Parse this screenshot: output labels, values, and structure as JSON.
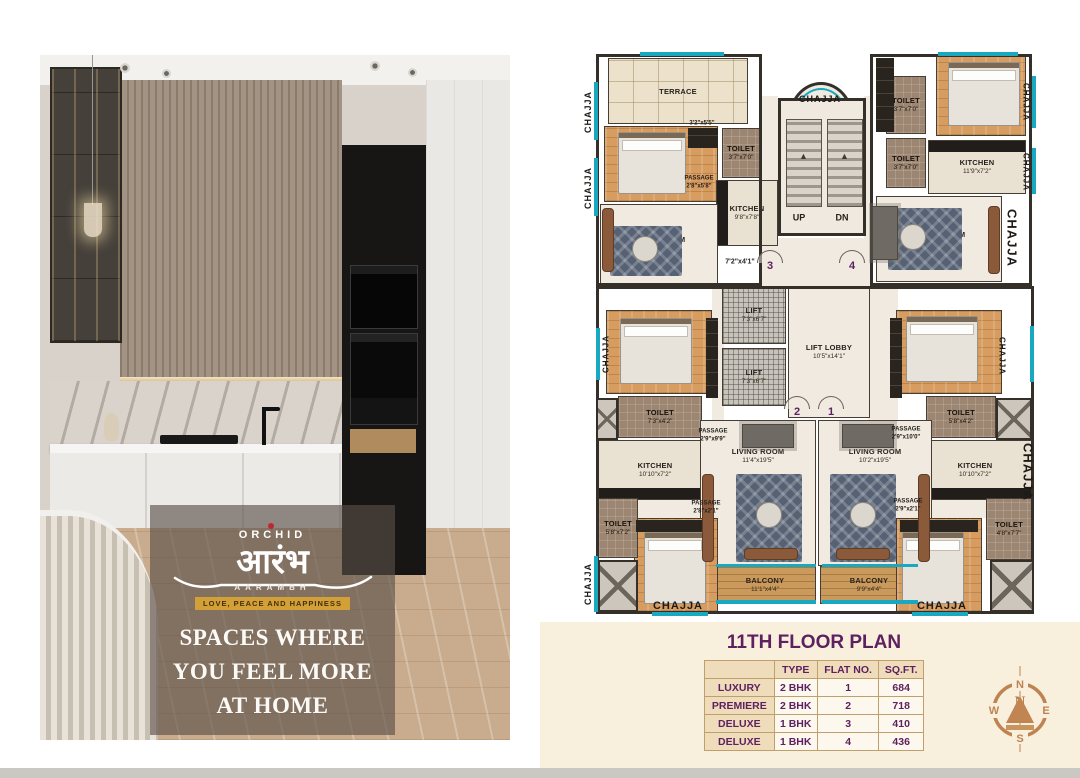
{
  "brand": {
    "name": "ORCHID",
    "devanagari": "आरंभ",
    "latin": "AARAMBH",
    "tagline": "LOVE, PEACE AND HAPPINESS"
  },
  "headline": {
    "lines": [
      "SPACES WHERE",
      "YOU FEEL MORE",
      "AT HOME"
    ]
  },
  "plan": {
    "chajja_text": "CHAJJA",
    "rooms": [
      {
        "name": "TERRACE",
        "dim": "",
        "x": 608,
        "y": 58,
        "w": 140,
        "h": 66,
        "f": "terrace"
      },
      {
        "name": "BEDROOM",
        "dim": "10'10\"x 9'5\"",
        "x": 604,
        "y": 126,
        "w": 114,
        "h": 76,
        "f": "wood"
      },
      {
        "name": "TOILET",
        "dim": "3'7\"x7'0\"",
        "x": 722,
        "y": 128,
        "w": 38,
        "h": 50,
        "f": "toilet"
      },
      {
        "name": "KITCHEN",
        "dim": "9'8\"x7'8\"",
        "x": 716,
        "y": 180,
        "w": 62,
        "h": 66,
        "f": "kitchen",
        "ck": "l"
      },
      {
        "name": "LIVING ROOM",
        "dim": "14'5\"x10'5\"",
        "x": 600,
        "y": 204,
        "w": 118,
        "h": 80,
        "f": "marble"
      },
      {
        "name": "TOILET",
        "dim": "3'7\"x7'0\"",
        "x": 886,
        "y": 76,
        "w": 40,
        "h": 58,
        "f": "toilet"
      },
      {
        "name": "TOILET",
        "dim": "3'7\"x7'0\"",
        "x": 886,
        "y": 138,
        "w": 40,
        "h": 50,
        "f": "toilet"
      },
      {
        "name": "BEDROOM",
        "dim": "11'8\"x9'5\"",
        "x": 936,
        "y": 56,
        "w": 90,
        "h": 80,
        "f": "wood"
      },
      {
        "name": "KITCHEN",
        "dim": "11'9\"x7'2\"",
        "x": 928,
        "y": 140,
        "w": 98,
        "h": 54,
        "f": "kitchen",
        "ck": "t"
      },
      {
        "name": "LIVING ROOM",
        "dim": "16'7\"x9'5\"",
        "x": 876,
        "y": 196,
        "w": 126,
        "h": 86,
        "f": "marble"
      },
      {
        "name": "LIFT",
        "dim": "7'3\"x6'7\"",
        "x": 722,
        "y": 286,
        "w": 64,
        "h": 58,
        "f": "lift"
      },
      {
        "name": "LIFT",
        "dim": "7'3\"x6'7\"",
        "x": 722,
        "y": 348,
        "w": 64,
        "h": 58,
        "f": "lift"
      },
      {
        "name": "LIFT LOBBY",
        "dim": "10'5\"x14'1\"",
        "x": 788,
        "y": 286,
        "w": 82,
        "h": 132,
        "f": "marble"
      },
      {
        "name": "BEDROOM",
        "dim": "11'9\"x10'0\"",
        "x": 606,
        "y": 310,
        "w": 106,
        "h": 84,
        "f": "wood"
      },
      {
        "name": "TOILET",
        "dim": "7'3\"x4'2\"",
        "x": 618,
        "y": 396,
        "w": 84,
        "h": 42,
        "f": "toilet"
      },
      {
        "name": "KITCHEN",
        "dim": "10'10\"x7'2\"",
        "x": 598,
        "y": 440,
        "w": 114,
        "h": 60,
        "f": "kitchen",
        "ck": "b"
      },
      {
        "name": "BEDROOM",
        "dim": "12'3\"x10'0\"",
        "x": 896,
        "y": 310,
        "w": 106,
        "h": 84,
        "f": "wood"
      },
      {
        "name": "TOILET",
        "dim": "5'8\"x4'2\"",
        "x": 926,
        "y": 396,
        "w": 70,
        "h": 42,
        "f": "toilet"
      },
      {
        "name": "KITCHEN",
        "dim": "10'10\"x7'2\"",
        "x": 918,
        "y": 440,
        "w": 114,
        "h": 60,
        "f": "kitchen",
        "ck": "b"
      },
      {
        "name": "LIVING ROOM",
        "dim": "11'4\"x19'5\"",
        "x": 700,
        "y": 420,
        "w": 116,
        "h": 146,
        "f": "marble",
        "la": "t"
      },
      {
        "name": "LIVING ROOM",
        "dim": "10'2\"x19'5\"",
        "x": 818,
        "y": 420,
        "w": 114,
        "h": 146,
        "f": "marble",
        "la": "t"
      },
      {
        "name": "BALCONY",
        "dim": "11'1\"x4'4\"",
        "x": 714,
        "y": 566,
        "w": 102,
        "h": 38,
        "f": "balcony"
      },
      {
        "name": "BALCONY",
        "dim": "9'9\"x4'4\"",
        "x": 820,
        "y": 566,
        "w": 98,
        "h": 38,
        "f": "balcony"
      },
      {
        "name": "BEDROOM",
        "dim": "10'2\"x11'8\"",
        "x": 634,
        "y": 518,
        "w": 84,
        "h": 94,
        "f": "wood"
      },
      {
        "name": "TOILET",
        "dim": "5'8\"x7'2\"",
        "x": 598,
        "y": 498,
        "w": 40,
        "h": 60,
        "f": "toilet"
      },
      {
        "name": "BEDROOM",
        "dim": "10'0\"x11'9\"",
        "x": 896,
        "y": 518,
        "w": 86,
        "h": 94,
        "f": "wood"
      },
      {
        "name": "TOILET",
        "dim": "4'8\"x7'7\"",
        "x": 986,
        "y": 498,
        "w": 46,
        "h": 62,
        "f": "toilet"
      }
    ],
    "labels": [
      {
        "t": "3'2\"x5'5\"",
        "x": 702,
        "y": 124,
        "s": 6
      },
      {
        "t": "PASSAGE",
        "d": "2'8\"x5'8\"",
        "x": 699,
        "y": 183,
        "s": 6
      },
      {
        "t": "7'2\"x4'1\"",
        "x": 740,
        "y": 263,
        "s": 7
      },
      {
        "t": "PASSAGE",
        "d": "2'9\"x9'9\"",
        "x": 713,
        "y": 436,
        "s": 6
      },
      {
        "t": "PASSAGE",
        "d": "2'9\"x10'0\"",
        "x": 906,
        "y": 434,
        "s": 6
      },
      {
        "t": "PASSAGE",
        "d": "2'8\"x2'1\"",
        "x": 706,
        "y": 508,
        "s": 6
      },
      {
        "t": "PASSAGE",
        "d": "2'9\"x2'1\"",
        "x": 908,
        "y": 506,
        "s": 6
      },
      {
        "t": "UP",
        "x": 799,
        "y": 218,
        "s": 9
      },
      {
        "t": "DN",
        "x": 842,
        "y": 218,
        "s": 9
      }
    ],
    "chajja": [
      {
        "x": 588,
        "y": 112,
        "o": "v",
        "s": 9
      },
      {
        "x": 588,
        "y": 188,
        "o": "v",
        "s": 9
      },
      {
        "x": 588,
        "y": 584,
        "o": "v",
        "s": 9
      },
      {
        "x": 606,
        "y": 354,
        "o": "v",
        "s": 8
      },
      {
        "x": 820,
        "y": 99,
        "o": "h",
        "s": 9
      },
      {
        "x": 1026,
        "y": 102,
        "o": "w",
        "s": 8
      },
      {
        "x": 1026,
        "y": 172,
        "o": "w",
        "s": 8
      },
      {
        "x": 1012,
        "y": 238,
        "o": "w",
        "s": 13
      },
      {
        "x": 1002,
        "y": 356,
        "o": "w",
        "s": 8
      },
      {
        "x": 1028,
        "y": 472,
        "o": "w",
        "s": 13
      },
      {
        "x": 678,
        "y": 606,
        "o": "h",
        "s": 11
      },
      {
        "x": 942,
        "y": 606,
        "o": "h",
        "s": 11
      }
    ],
    "flats": [
      {
        "n": "3",
        "x": 770,
        "y": 250
      },
      {
        "n": "4",
        "x": 852,
        "y": 250
      },
      {
        "n": "2",
        "x": 797,
        "y": 396
      },
      {
        "n": "1",
        "x": 831,
        "y": 396
      }
    ]
  },
  "summary": {
    "title": "11TH FLOOR PLAN",
    "headers": [
      "",
      "TYPE",
      "FLAT NO.",
      "SQ.FT."
    ],
    "rows": [
      [
        "LUXURY",
        "2 BHK",
        "1",
        "684"
      ],
      [
        "PREMIERE",
        "2 BHK",
        "2",
        "718"
      ],
      [
        "DELUXE",
        "1 BHK",
        "3",
        "410"
      ],
      [
        "DELUXE",
        "1 BHK",
        "4",
        "436"
      ]
    ]
  },
  "compass": {
    "n": "N",
    "e": "E",
    "s": "S",
    "w": "W"
  },
  "colors": {
    "accent_teal": "#19a8bf",
    "title_purple": "#5e2160",
    "gold_bar": "#d3a037",
    "table_tan": "#eedcbb",
    "compass_tan": "#c08552"
  }
}
